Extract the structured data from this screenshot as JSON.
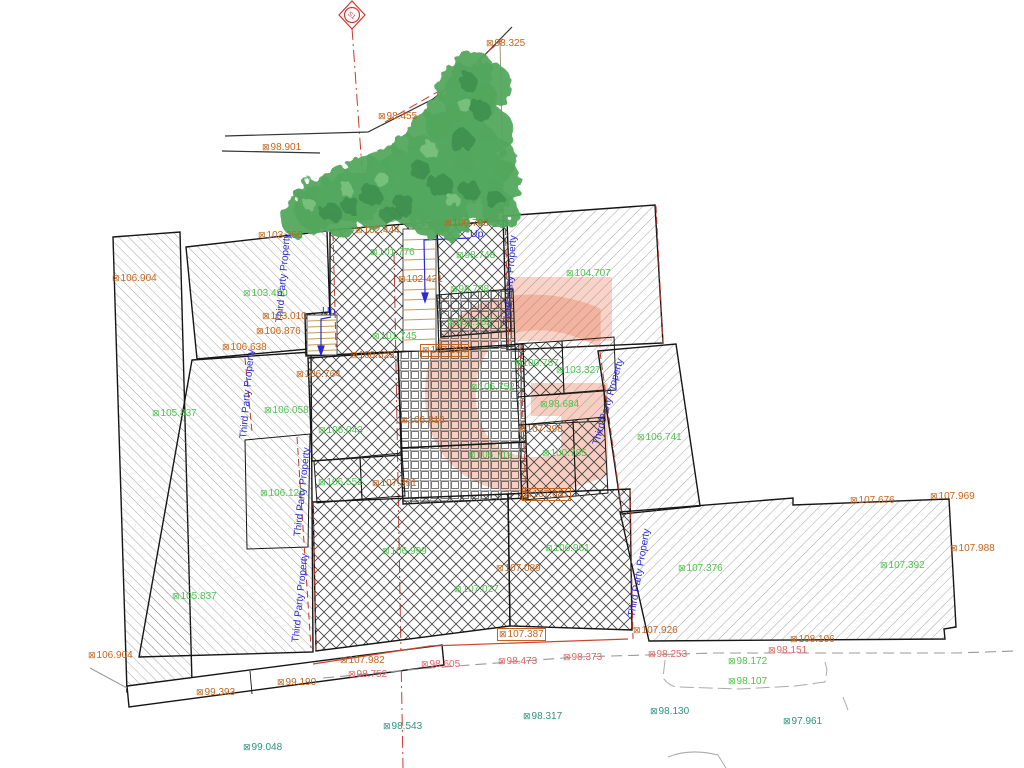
{
  "drawing": {
    "type": "topographical site survey plan",
    "marker_symbol": "⊠",
    "colors": {
      "orange": "#c2641c",
      "green": "#4ec34e",
      "teal": "#2f9180",
      "pink": "#e26464",
      "blue": "#2a2ad4",
      "red_line": "#cc3a2e",
      "tree_green": "#53a85e",
      "stair_tan": "#c49a58",
      "watermark": "#ee8464"
    },
    "station": {
      "label": "S1"
    },
    "watermark_letter": "G",
    "up_labels": {
      "text": "Up",
      "positions": [
        {
          "x": 322,
          "y": 306
        },
        {
          "x": 470,
          "y": 229
        }
      ]
    },
    "third_party_property": {
      "text": "Third Party Property",
      "positions": [
        {
          "x": 284,
          "y": 278,
          "r": -85
        },
        {
          "x": 248,
          "y": 394,
          "r": -85
        },
        {
          "x": 303,
          "y": 492,
          "r": -84
        },
        {
          "x": 301,
          "y": 598,
          "r": -84
        },
        {
          "x": 511,
          "y": 280,
          "r": -86
        },
        {
          "x": 609,
          "y": 402,
          "r": -74
        },
        {
          "x": 640,
          "y": 573,
          "r": -80
        }
      ]
    },
    "spot_levels": [
      {
        "x": 262,
        "y": 142,
        "value": "98.901",
        "color": "orange",
        "boxed": false
      },
      {
        "x": 486,
        "y": 38,
        "value": "98.325",
        "color": "orange",
        "boxed": false
      },
      {
        "x": 378,
        "y": 111,
        "value": "98.455",
        "color": "orange",
        "boxed": false
      },
      {
        "x": 355,
        "y": 225,
        "value": "102.444",
        "color": "orange",
        "boxed": false
      },
      {
        "x": 258,
        "y": 230,
        "value": "103.250",
        "color": "orange",
        "boxed": false
      },
      {
        "x": 444,
        "y": 218,
        "value": "100.708",
        "color": "orange",
        "boxed": false
      },
      {
        "x": 398,
        "y": 274,
        "value": "102.421",
        "color": "orange",
        "boxed": false
      },
      {
        "x": 112,
        "y": 273,
        "value": "106.904",
        "color": "orange",
        "boxed": false
      },
      {
        "x": 262,
        "y": 311,
        "value": "103.010",
        "color": "orange",
        "boxed": false
      },
      {
        "x": 256,
        "y": 326,
        "value": "106.876",
        "color": "orange",
        "boxed": false
      },
      {
        "x": 222,
        "y": 342,
        "value": "106.638",
        "color": "orange",
        "boxed": false
      },
      {
        "x": 420,
        "y": 344,
        "value": "107.394",
        "color": "orange",
        "boxed": true
      },
      {
        "x": 296,
        "y": 369,
        "value": "106.764",
        "color": "orange",
        "boxed": false
      },
      {
        "x": 350,
        "y": 350,
        "value": "100.523",
        "color": "orange",
        "boxed": false
      },
      {
        "x": 400,
        "y": 415,
        "value": "106.816",
        "color": "orange",
        "boxed": false
      },
      {
        "x": 372,
        "y": 478,
        "value": "107.891",
        "color": "orange",
        "boxed": false
      },
      {
        "x": 518,
        "y": 424,
        "value": "107.398",
        "color": "orange",
        "boxed": false
      },
      {
        "x": 522,
        "y": 488,
        "value": "107.681",
        "color": "orange",
        "boxed": true
      },
      {
        "x": 496,
        "y": 563,
        "value": "107.089",
        "color": "orange",
        "boxed": false
      },
      {
        "x": 497,
        "y": 628,
        "value": "107.387",
        "color": "orange",
        "boxed": true
      },
      {
        "x": 340,
        "y": 655,
        "value": "107.982",
        "color": "orange",
        "boxed": false
      },
      {
        "x": 633,
        "y": 625,
        "value": "107.926",
        "color": "orange",
        "boxed": false
      },
      {
        "x": 790,
        "y": 634,
        "value": "108.106",
        "color": "orange",
        "boxed": false
      },
      {
        "x": 850,
        "y": 495,
        "value": "107.676",
        "color": "orange",
        "boxed": false
      },
      {
        "x": 930,
        "y": 491,
        "value": "107.969",
        "color": "orange",
        "boxed": false
      },
      {
        "x": 950,
        "y": 543,
        "value": "107.988",
        "color": "orange",
        "boxed": false
      },
      {
        "x": 88,
        "y": 650,
        "value": "106.904",
        "color": "orange",
        "boxed": false
      },
      {
        "x": 196,
        "y": 687,
        "value": "99.393",
        "color": "orange",
        "boxed": false
      },
      {
        "x": 277,
        "y": 677,
        "value": "99.190",
        "color": "orange",
        "boxed": false
      },
      {
        "x": 243,
        "y": 288,
        "value": "103.490",
        "color": "green",
        "boxed": false
      },
      {
        "x": 370,
        "y": 247,
        "value": "101.776",
        "color": "green",
        "boxed": false
      },
      {
        "x": 372,
        "y": 331,
        "value": "101.745",
        "color": "green",
        "boxed": false
      },
      {
        "x": 456,
        "y": 250,
        "value": "98.748",
        "color": "green",
        "boxed": false
      },
      {
        "x": 450,
        "y": 284,
        "value": "98.708",
        "color": "green",
        "boxed": false
      },
      {
        "x": 566,
        "y": 268,
        "value": "104.707",
        "color": "green",
        "boxed": false
      },
      {
        "x": 447,
        "y": 317,
        "value": "101.182",
        "color": "green",
        "boxed": false
      },
      {
        "x": 152,
        "y": 408,
        "value": "105.837",
        "color": "green",
        "boxed": false
      },
      {
        "x": 264,
        "y": 405,
        "value": "106.058",
        "color": "green",
        "boxed": false
      },
      {
        "x": 260,
        "y": 488,
        "value": "106.120",
        "color": "green",
        "boxed": false
      },
      {
        "x": 172,
        "y": 591,
        "value": "105.837",
        "color": "green",
        "boxed": false
      },
      {
        "x": 318,
        "y": 425,
        "value": "106.043",
        "color": "green",
        "boxed": false
      },
      {
        "x": 470,
        "y": 382,
        "value": "106.752",
        "color": "green",
        "boxed": false
      },
      {
        "x": 318,
        "y": 477,
        "value": "106.552",
        "color": "green",
        "boxed": false
      },
      {
        "x": 468,
        "y": 450,
        "value": "106.719",
        "color": "green",
        "boxed": false
      },
      {
        "x": 514,
        "y": 358,
        "value": "100.787",
        "color": "green",
        "boxed": false
      },
      {
        "x": 556,
        "y": 365,
        "value": "103.327",
        "color": "green",
        "boxed": false
      },
      {
        "x": 540,
        "y": 399,
        "value": "98.684",
        "color": "green",
        "boxed": false
      },
      {
        "x": 542,
        "y": 448,
        "value": "100.785",
        "color": "green",
        "boxed": false
      },
      {
        "x": 637,
        "y": 432,
        "value": "106.741",
        "color": "green",
        "boxed": false
      },
      {
        "x": 382,
        "y": 546,
        "value": "106.999",
        "color": "green",
        "boxed": false
      },
      {
        "x": 545,
        "y": 543,
        "value": "106.961",
        "color": "green",
        "boxed": false
      },
      {
        "x": 454,
        "y": 584,
        "value": "107.027",
        "color": "green",
        "boxed": false
      },
      {
        "x": 678,
        "y": 563,
        "value": "107.376",
        "color": "green",
        "boxed": false
      },
      {
        "x": 880,
        "y": 560,
        "value": "107.392",
        "color": "green",
        "boxed": false
      },
      {
        "x": 728,
        "y": 656,
        "value": "98.172",
        "color": "green",
        "boxed": false
      },
      {
        "x": 728,
        "y": 676,
        "value": "98.107",
        "color": "green",
        "boxed": false
      },
      {
        "x": 383,
        "y": 721,
        "value": "98.543",
        "color": "teal",
        "boxed": false
      },
      {
        "x": 523,
        "y": 711,
        "value": "98.317",
        "color": "teal",
        "boxed": false
      },
      {
        "x": 650,
        "y": 706,
        "value": "98.130",
        "color": "teal",
        "boxed": false
      },
      {
        "x": 783,
        "y": 716,
        "value": "97.961",
        "color": "teal",
        "boxed": false
      },
      {
        "x": 243,
        "y": 742,
        "value": "99.048",
        "color": "teal",
        "boxed": false
      },
      {
        "x": 348,
        "y": 669,
        "value": "98.752",
        "color": "pink",
        "boxed": false
      },
      {
        "x": 421,
        "y": 659,
        "value": "98.605",
        "color": "pink",
        "boxed": false
      },
      {
        "x": 498,
        "y": 656,
        "value": "98.473",
        "color": "pink",
        "boxed": false
      },
      {
        "x": 563,
        "y": 652,
        "value": "98.373",
        "color": "pink",
        "boxed": false
      },
      {
        "x": 648,
        "y": 649,
        "value": "98.253",
        "color": "pink",
        "boxed": false
      },
      {
        "x": 768,
        "y": 645,
        "value": "98.151",
        "color": "pink",
        "boxed": false
      }
    ]
  }
}
